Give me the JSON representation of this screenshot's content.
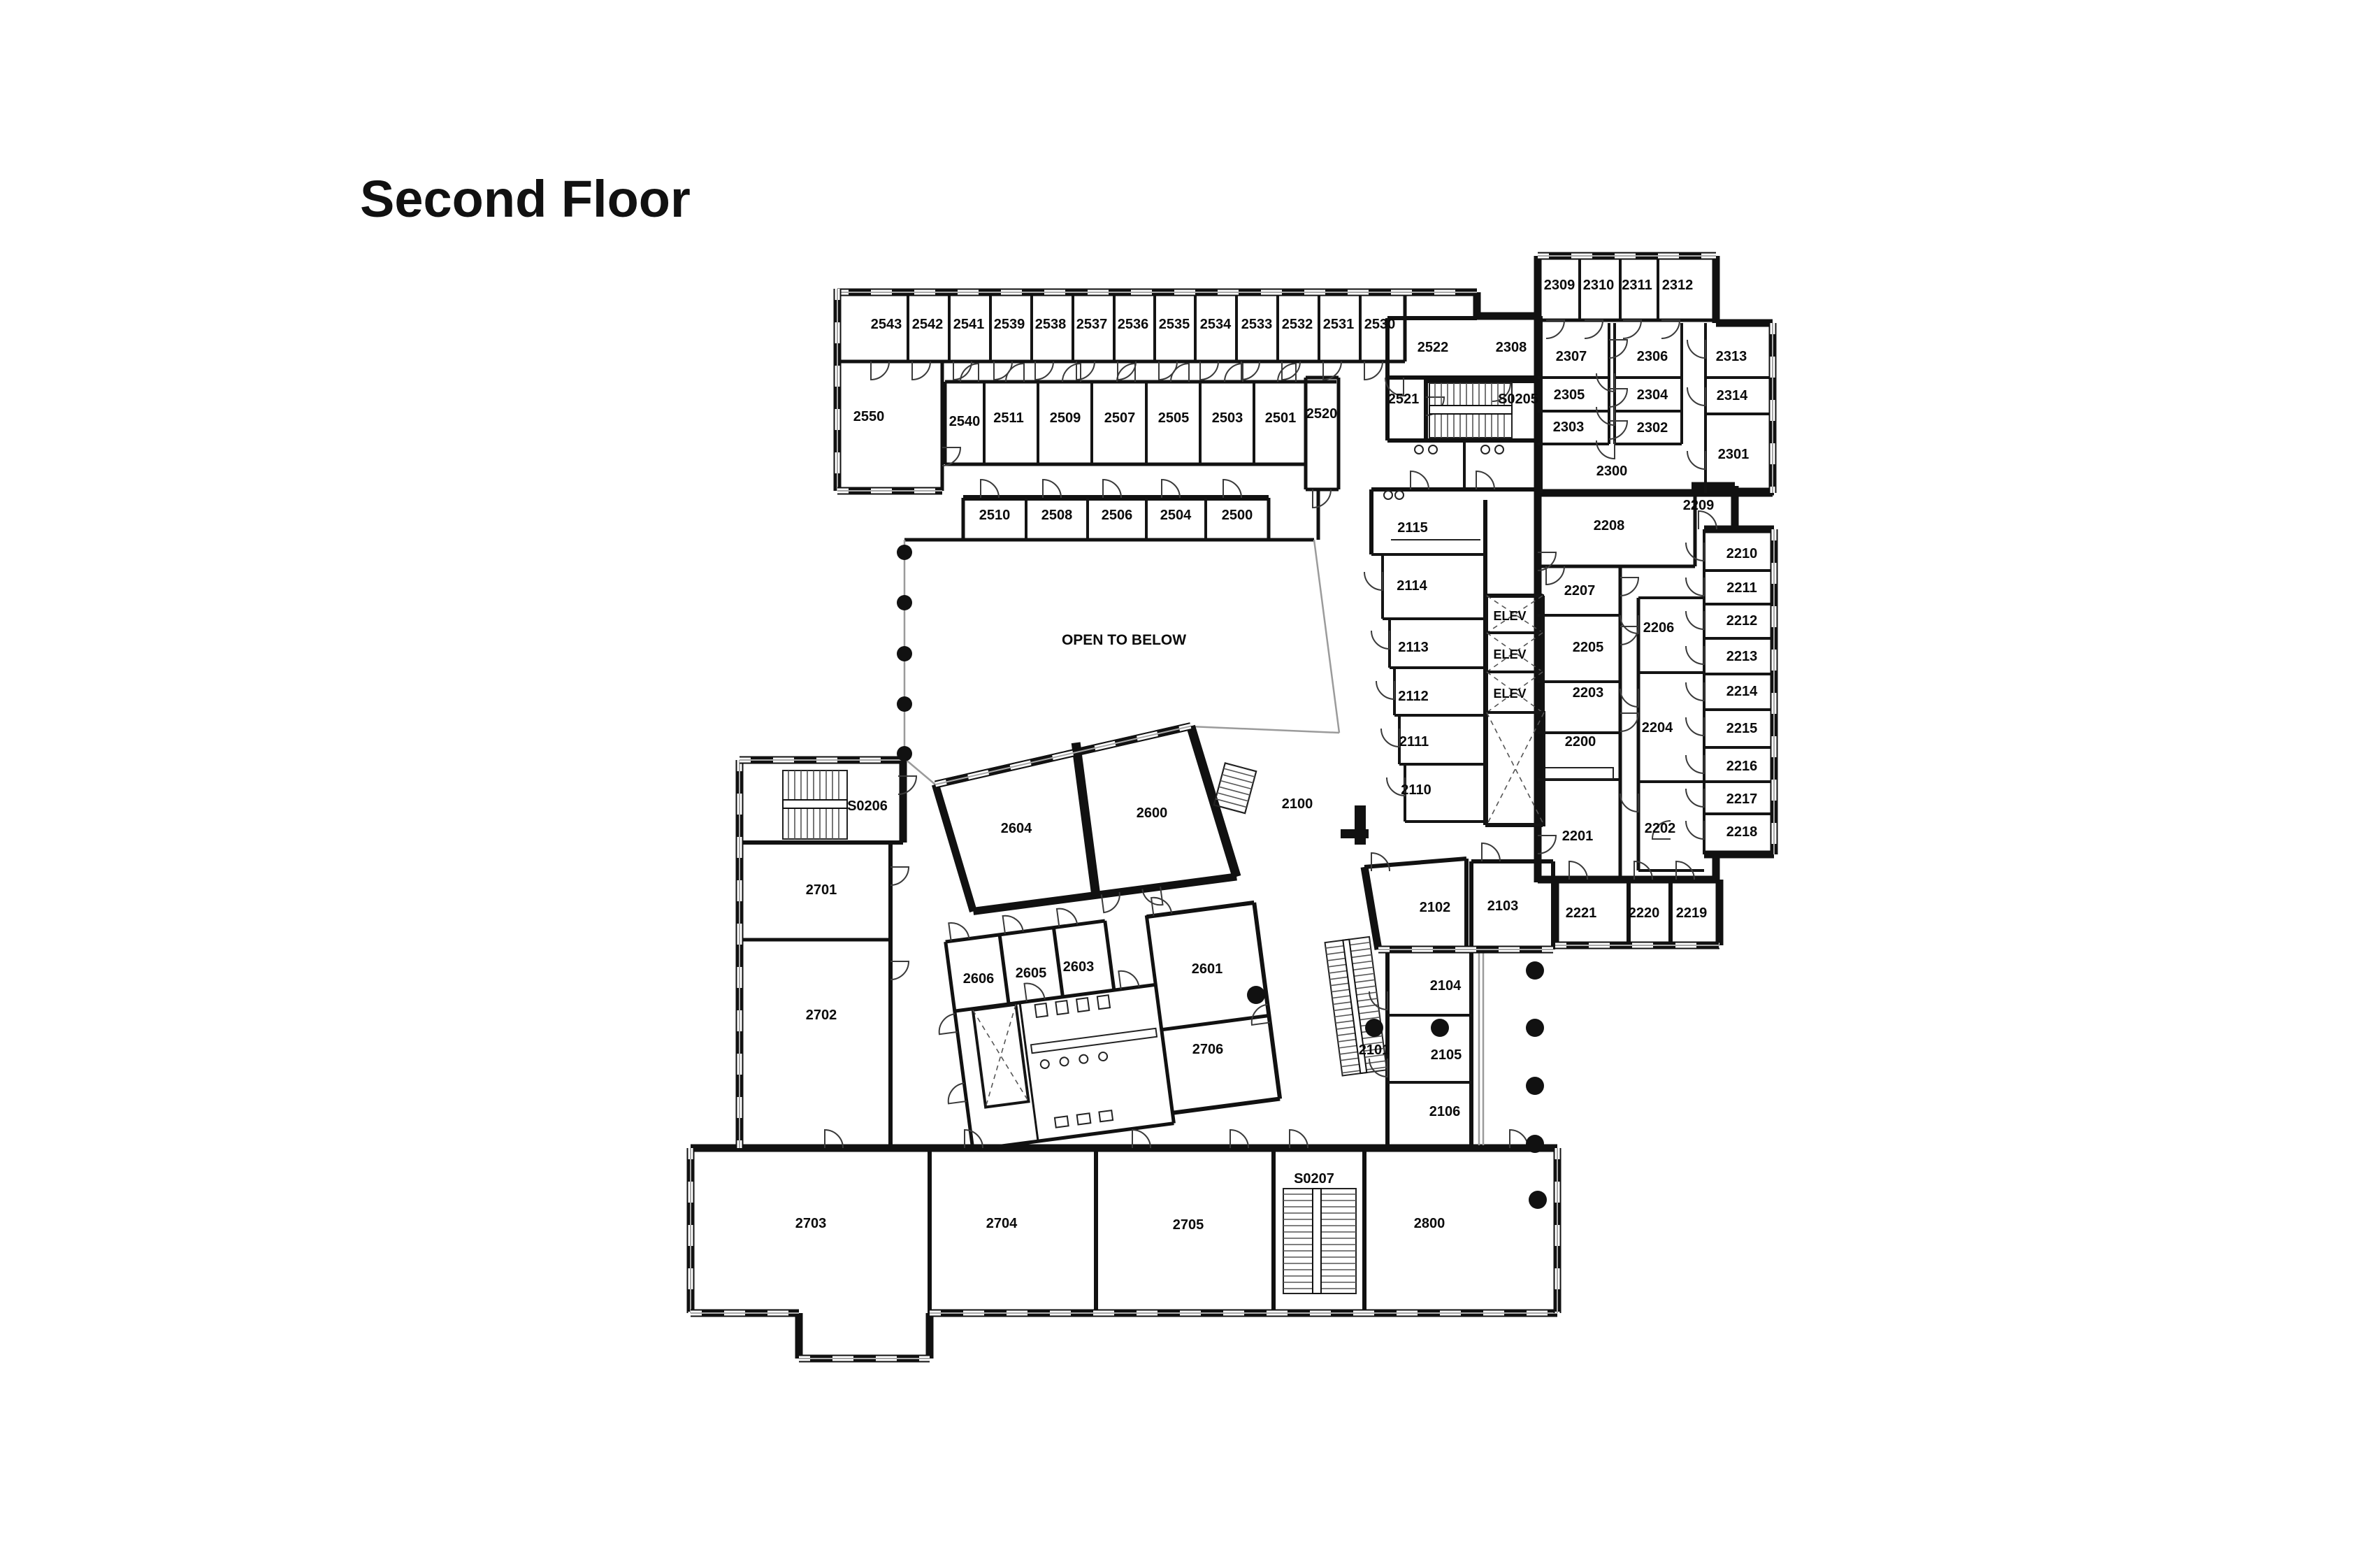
{
  "title": "Second Floor",
  "open_to_below_label": "OPEN TO BELOW",
  "elevator_label": "ELEV",
  "rooms": [
    {
      "id": "2543"
    },
    {
      "id": "2542"
    },
    {
      "id": "2541"
    },
    {
      "id": "2539"
    },
    {
      "id": "2538"
    },
    {
      "id": "2537"
    },
    {
      "id": "2536"
    },
    {
      "id": "2535"
    },
    {
      "id": "2534"
    },
    {
      "id": "2533"
    },
    {
      "id": "2532"
    },
    {
      "id": "2531"
    },
    {
      "id": "2530"
    },
    {
      "id": "2550"
    },
    {
      "id": "2540"
    },
    {
      "id": "2511"
    },
    {
      "id": "2509"
    },
    {
      "id": "2507"
    },
    {
      "id": "2505"
    },
    {
      "id": "2503"
    },
    {
      "id": "2501"
    },
    {
      "id": "2520"
    },
    {
      "id": "2510"
    },
    {
      "id": "2508"
    },
    {
      "id": "2506"
    },
    {
      "id": "2504"
    },
    {
      "id": "2500"
    },
    {
      "id": "2522"
    },
    {
      "id": "2308"
    },
    {
      "id": "2521"
    },
    {
      "id": "S0205"
    },
    {
      "id": "2309"
    },
    {
      "id": "2310"
    },
    {
      "id": "2311"
    },
    {
      "id": "2312"
    },
    {
      "id": "2307"
    },
    {
      "id": "2306"
    },
    {
      "id": "2313"
    },
    {
      "id": "2305"
    },
    {
      "id": "2304"
    },
    {
      "id": "2314"
    },
    {
      "id": "2303"
    },
    {
      "id": "2302"
    },
    {
      "id": "2301"
    },
    {
      "id": "2300"
    },
    {
      "id": "2208"
    },
    {
      "id": "2209"
    },
    {
      "id": "2210"
    },
    {
      "id": "2211"
    },
    {
      "id": "2212"
    },
    {
      "id": "2213"
    },
    {
      "id": "2214"
    },
    {
      "id": "2215"
    },
    {
      "id": "2216"
    },
    {
      "id": "2217"
    },
    {
      "id": "2218"
    },
    {
      "id": "2115"
    },
    {
      "id": "2114"
    },
    {
      "id": "2113"
    },
    {
      "id": "2112"
    },
    {
      "id": "2111"
    },
    {
      "id": "2110"
    },
    {
      "id": "2207"
    },
    {
      "id": "2206"
    },
    {
      "id": "2205"
    },
    {
      "id": "2203"
    },
    {
      "id": "2204"
    },
    {
      "id": "2200"
    },
    {
      "id": "2201"
    },
    {
      "id": "2202"
    },
    {
      "id": "2221"
    },
    {
      "id": "2220"
    },
    {
      "id": "2219"
    },
    {
      "id": "2100"
    },
    {
      "id": "2604"
    },
    {
      "id": "2600"
    },
    {
      "id": "2102"
    },
    {
      "id": "2103"
    },
    {
      "id": "2606"
    },
    {
      "id": "2605"
    },
    {
      "id": "2603"
    },
    {
      "id": "2601"
    },
    {
      "id": "2706"
    },
    {
      "id": "2104"
    },
    {
      "id": "2105"
    },
    {
      "id": "2106"
    },
    {
      "id": "2101"
    },
    {
      "id": "S0206"
    },
    {
      "id": "2701"
    },
    {
      "id": "2702"
    },
    {
      "id": "2703"
    },
    {
      "id": "2704"
    },
    {
      "id": "2705"
    },
    {
      "id": "S0207"
    },
    {
      "id": "2800"
    }
  ]
}
